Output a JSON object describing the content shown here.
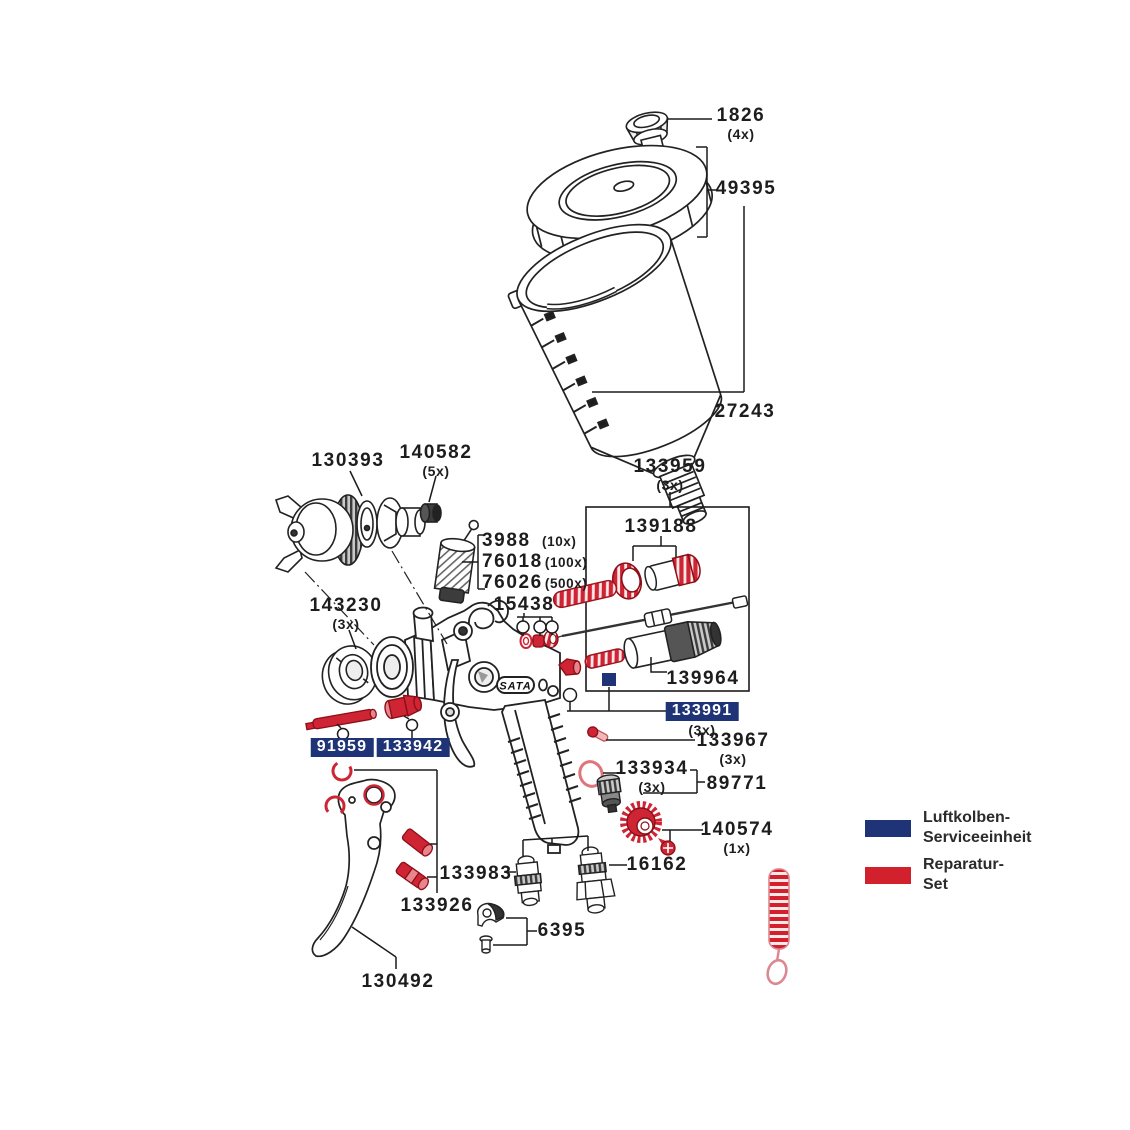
{
  "diagram": {
    "brand": "SATA",
    "labels": [
      {
        "number": "1826",
        "qty": "(4x)"
      },
      {
        "number": "49395",
        "qty": ""
      },
      {
        "number": "27243",
        "qty": ""
      },
      {
        "number": "130393",
        "qty": ""
      },
      {
        "number": "140582",
        "qty": "(5x)"
      },
      {
        "number": "3988",
        "qty": "(10x)"
      },
      {
        "number": "76018",
        "qty": "(100x)"
      },
      {
        "number": "76026",
        "qty": "(500x)"
      },
      {
        "number": "143230",
        "qty": "(3x)"
      },
      {
        "number": "15438",
        "qty": ""
      },
      {
        "number": "133959",
        "qty": "(3x)"
      },
      {
        "number": "139188",
        "qty": ""
      },
      {
        "number": "139964",
        "qty": ""
      },
      {
        "number": "133991",
        "qty": "(3x)",
        "set": "luftkolben-serviceeinheit"
      },
      {
        "number": "133967",
        "qty": "(3x)"
      },
      {
        "number": "133934",
        "qty": "(3x)"
      },
      {
        "number": "89771",
        "qty": ""
      },
      {
        "number": "140574",
        "qty": "(1x)"
      },
      {
        "number": "16162",
        "qty": ""
      },
      {
        "number": "91959",
        "qty": "",
        "set": "luftkolben-serviceeinheit"
      },
      {
        "number": "133942",
        "qty": "",
        "set": "luftkolben-serviceeinheit"
      },
      {
        "number": "133983",
        "qty": ""
      },
      {
        "number": "133926",
        "qty": ""
      },
      {
        "number": "6395",
        "qty": ""
      },
      {
        "number": "130492",
        "qty": ""
      }
    ],
    "legend": {
      "items": [
        {
          "id": "luftkolben-serviceeinheit",
          "color": "#1e3476",
          "label": "Luftkolben-\nServiceeinheit"
        },
        {
          "id": "reparatur-set",
          "color": "#d2212c",
          "label": "Reparatur-\nSet"
        }
      ]
    },
    "colors": {
      "highlight_blue": "#1e3476",
      "highlight_red": "#cf2433"
    }
  }
}
